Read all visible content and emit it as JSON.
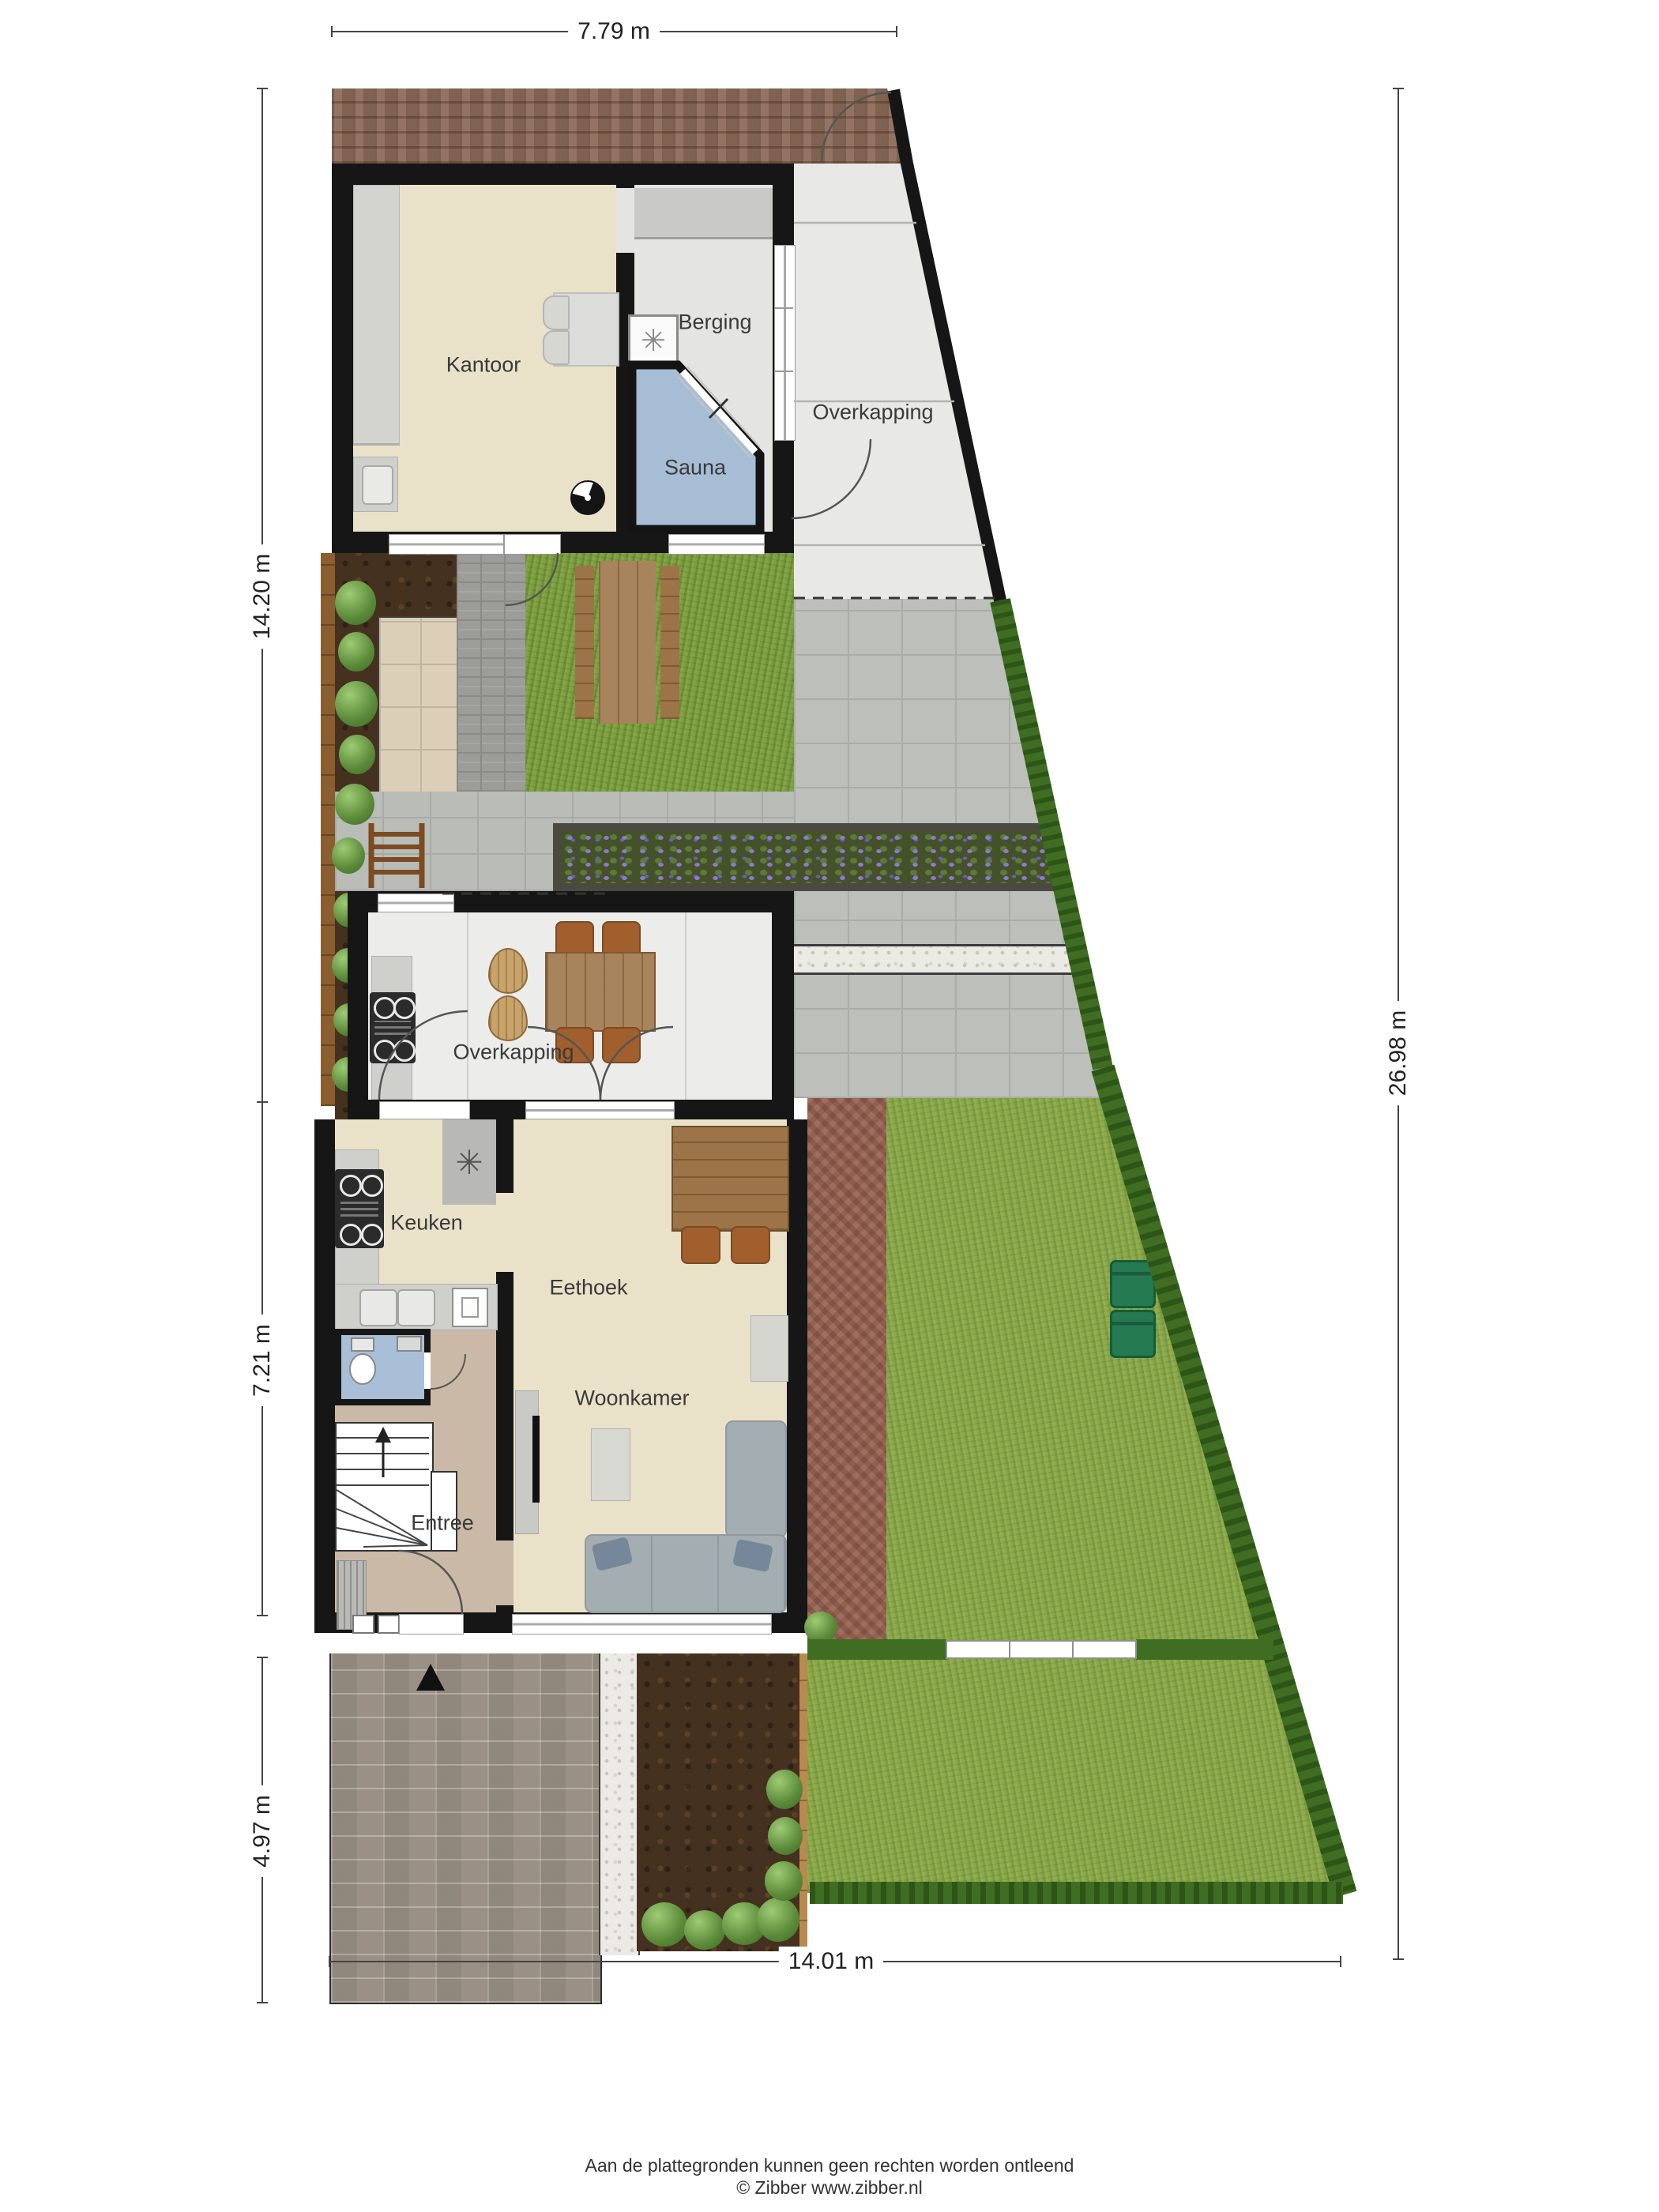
{
  "meta": {
    "title": "Plattegrond begane grond met tuin",
    "source_brand": "Zibber"
  },
  "rooms": {
    "kantoor": "Kantoor",
    "berging": "Berging",
    "sauna": "Sauna",
    "overkapping_top": "Overkapping",
    "overkapping_mid": "Overkapping",
    "keuken": "Keuken",
    "eethoek": "Eethoek",
    "woonkamer": "Woonkamer",
    "entree": "Entree"
  },
  "dimensions": {
    "top": "7.79 m",
    "left_upper": "14.20 m",
    "left_middle": "7.21 m",
    "left_lower": "4.97 m",
    "right": "26.98 m",
    "bottom": "14.01 m"
  },
  "footer": {
    "disclaimer": "Aan de plattegronden kunnen geen rechten worden ontleend",
    "copyright": "© Zibber www.zibber.nl"
  },
  "icons": {
    "washing_machine": "✳",
    "vent_unit": "✳"
  },
  "colors": {
    "wall": "#161616",
    "floor_cream": "#eae1c9",
    "floor_gray": "#e4e4e2",
    "floor_entree": "#cbb9a7",
    "floor_toilet": "#a9bfd7",
    "sauna_blue": "#a7bdd6",
    "grass": "#7ea043",
    "hedge": "#3f6d22",
    "pavers": "#b9bcb7",
    "tiles": "#dccfb7",
    "gravel": "#eceae5",
    "soil": "#45311f",
    "brick_band": "#8a6a57",
    "brick_terrace": "#96604f",
    "driveway": "#9a9187",
    "wood": "#a8845c",
    "bin_green": "#257a52",
    "label_text": "#3a3a3a"
  }
}
